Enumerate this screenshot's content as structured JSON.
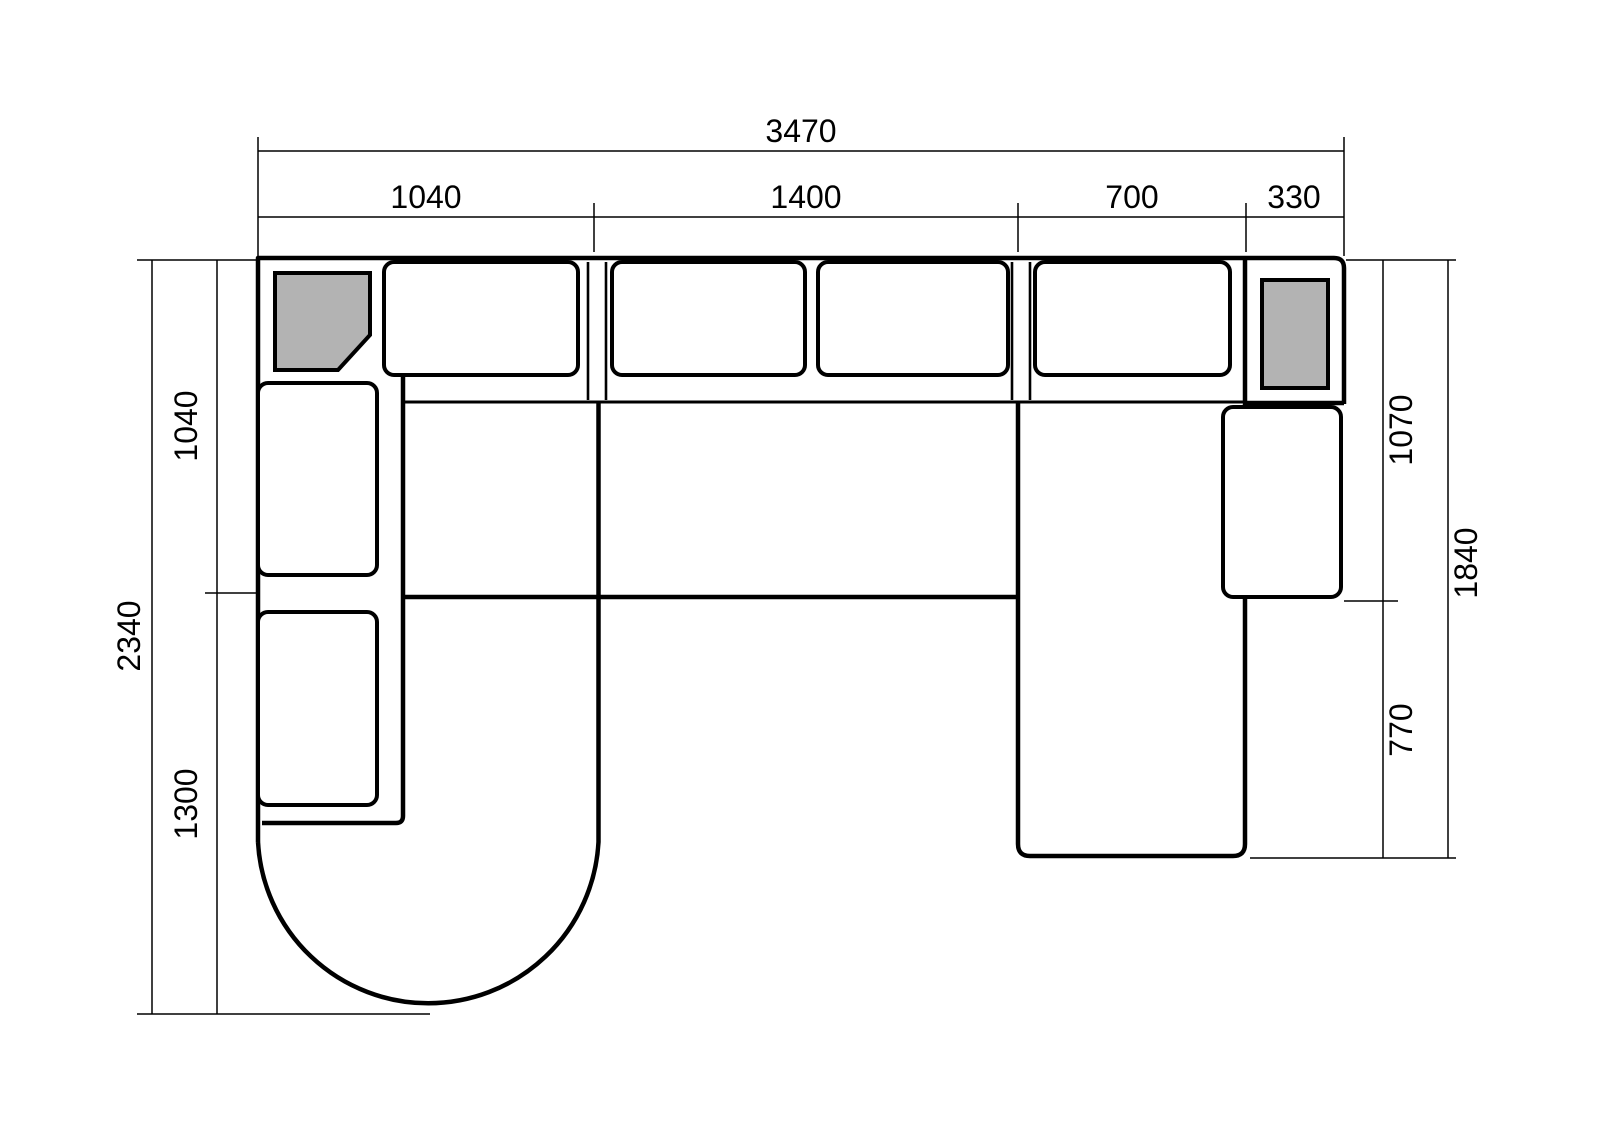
{
  "diagram": {
    "units": "mm",
    "colors": {
      "line": "#000000",
      "background": "#ffffff",
      "cushion_fill": "#ffffff",
      "accent_gray": "#b3b3b3"
    },
    "dims": {
      "top_total": "3470",
      "top_segments": [
        "1040",
        "1400",
        "700",
        "330"
      ],
      "left_total": "2340",
      "left_segments": [
        "1040",
        "1300"
      ],
      "right_total": "1840",
      "right_segments": [
        "1070",
        "770"
      ]
    }
  }
}
